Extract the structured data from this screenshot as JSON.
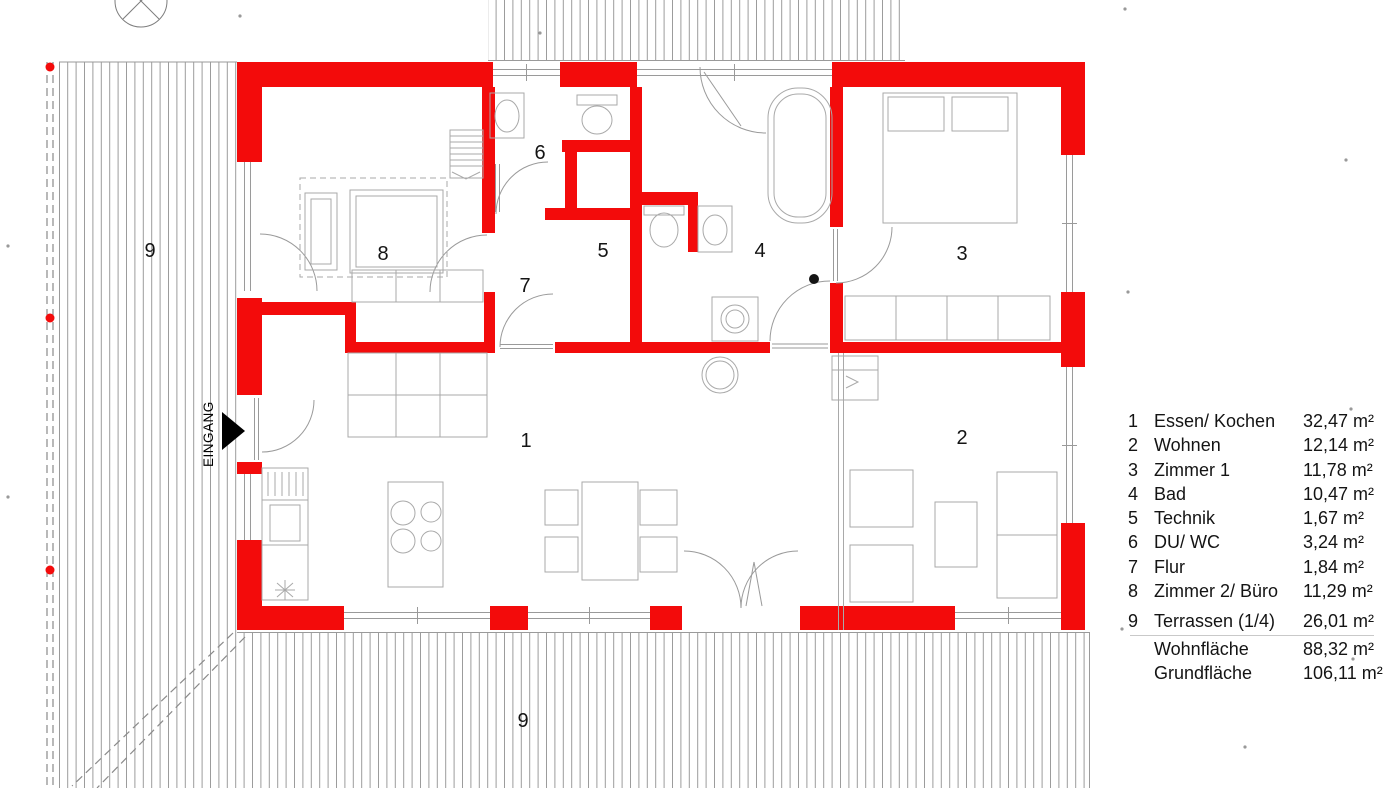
{
  "plan": {
    "entrance_label": "EINGANG",
    "room_labels": [
      {
        "id": "1",
        "x": 526,
        "y": 447
      },
      {
        "id": "2",
        "x": 962,
        "y": 444
      },
      {
        "id": "3",
        "x": 962,
        "y": 260
      },
      {
        "id": "4",
        "x": 760,
        "y": 257
      },
      {
        "id": "5",
        "x": 603,
        "y": 257
      },
      {
        "id": "6",
        "x": 540,
        "y": 159
      },
      {
        "id": "7",
        "x": 525,
        "y": 292
      },
      {
        "id": "8",
        "x": 383,
        "y": 260
      },
      {
        "id": "9",
        "x": 150,
        "y": 257
      },
      {
        "id": "9",
        "x": 523,
        "y": 727
      }
    ],
    "colors": {
      "wall_red": "#f30b0b",
      "line_gray": "#9a9a9a",
      "text": "#141414"
    }
  },
  "legend": {
    "rows": [
      {
        "num": "1",
        "label": "Essen/ Kochen",
        "area": "32,47 m²"
      },
      {
        "num": "2",
        "label": "Wohnen",
        "area": "12,14 m²"
      },
      {
        "num": "3",
        "label": "Zimmer 1",
        "area": "11,78 m²"
      },
      {
        "num": "4",
        "label": "Bad",
        "area": "10,47 m²"
      },
      {
        "num": "5",
        "label": "Technik",
        "area": "1,67 m²"
      },
      {
        "num": "6",
        "label": "DU/ WC",
        "area": "3,24 m²"
      },
      {
        "num": "7",
        "label": "Flur",
        "area": "1,84 m²"
      },
      {
        "num": "8",
        "label": "Zimmer 2/ Büro",
        "area": "11,29 m²"
      },
      {
        "num": "9",
        "label": "Terrassen (1/4)",
        "area": "26,01 m²"
      }
    ],
    "totals": [
      {
        "label": "Wohnfläche",
        "area": "88,32 m²"
      },
      {
        "label": "Grundfläche",
        "area": "106,11 m²"
      }
    ]
  }
}
